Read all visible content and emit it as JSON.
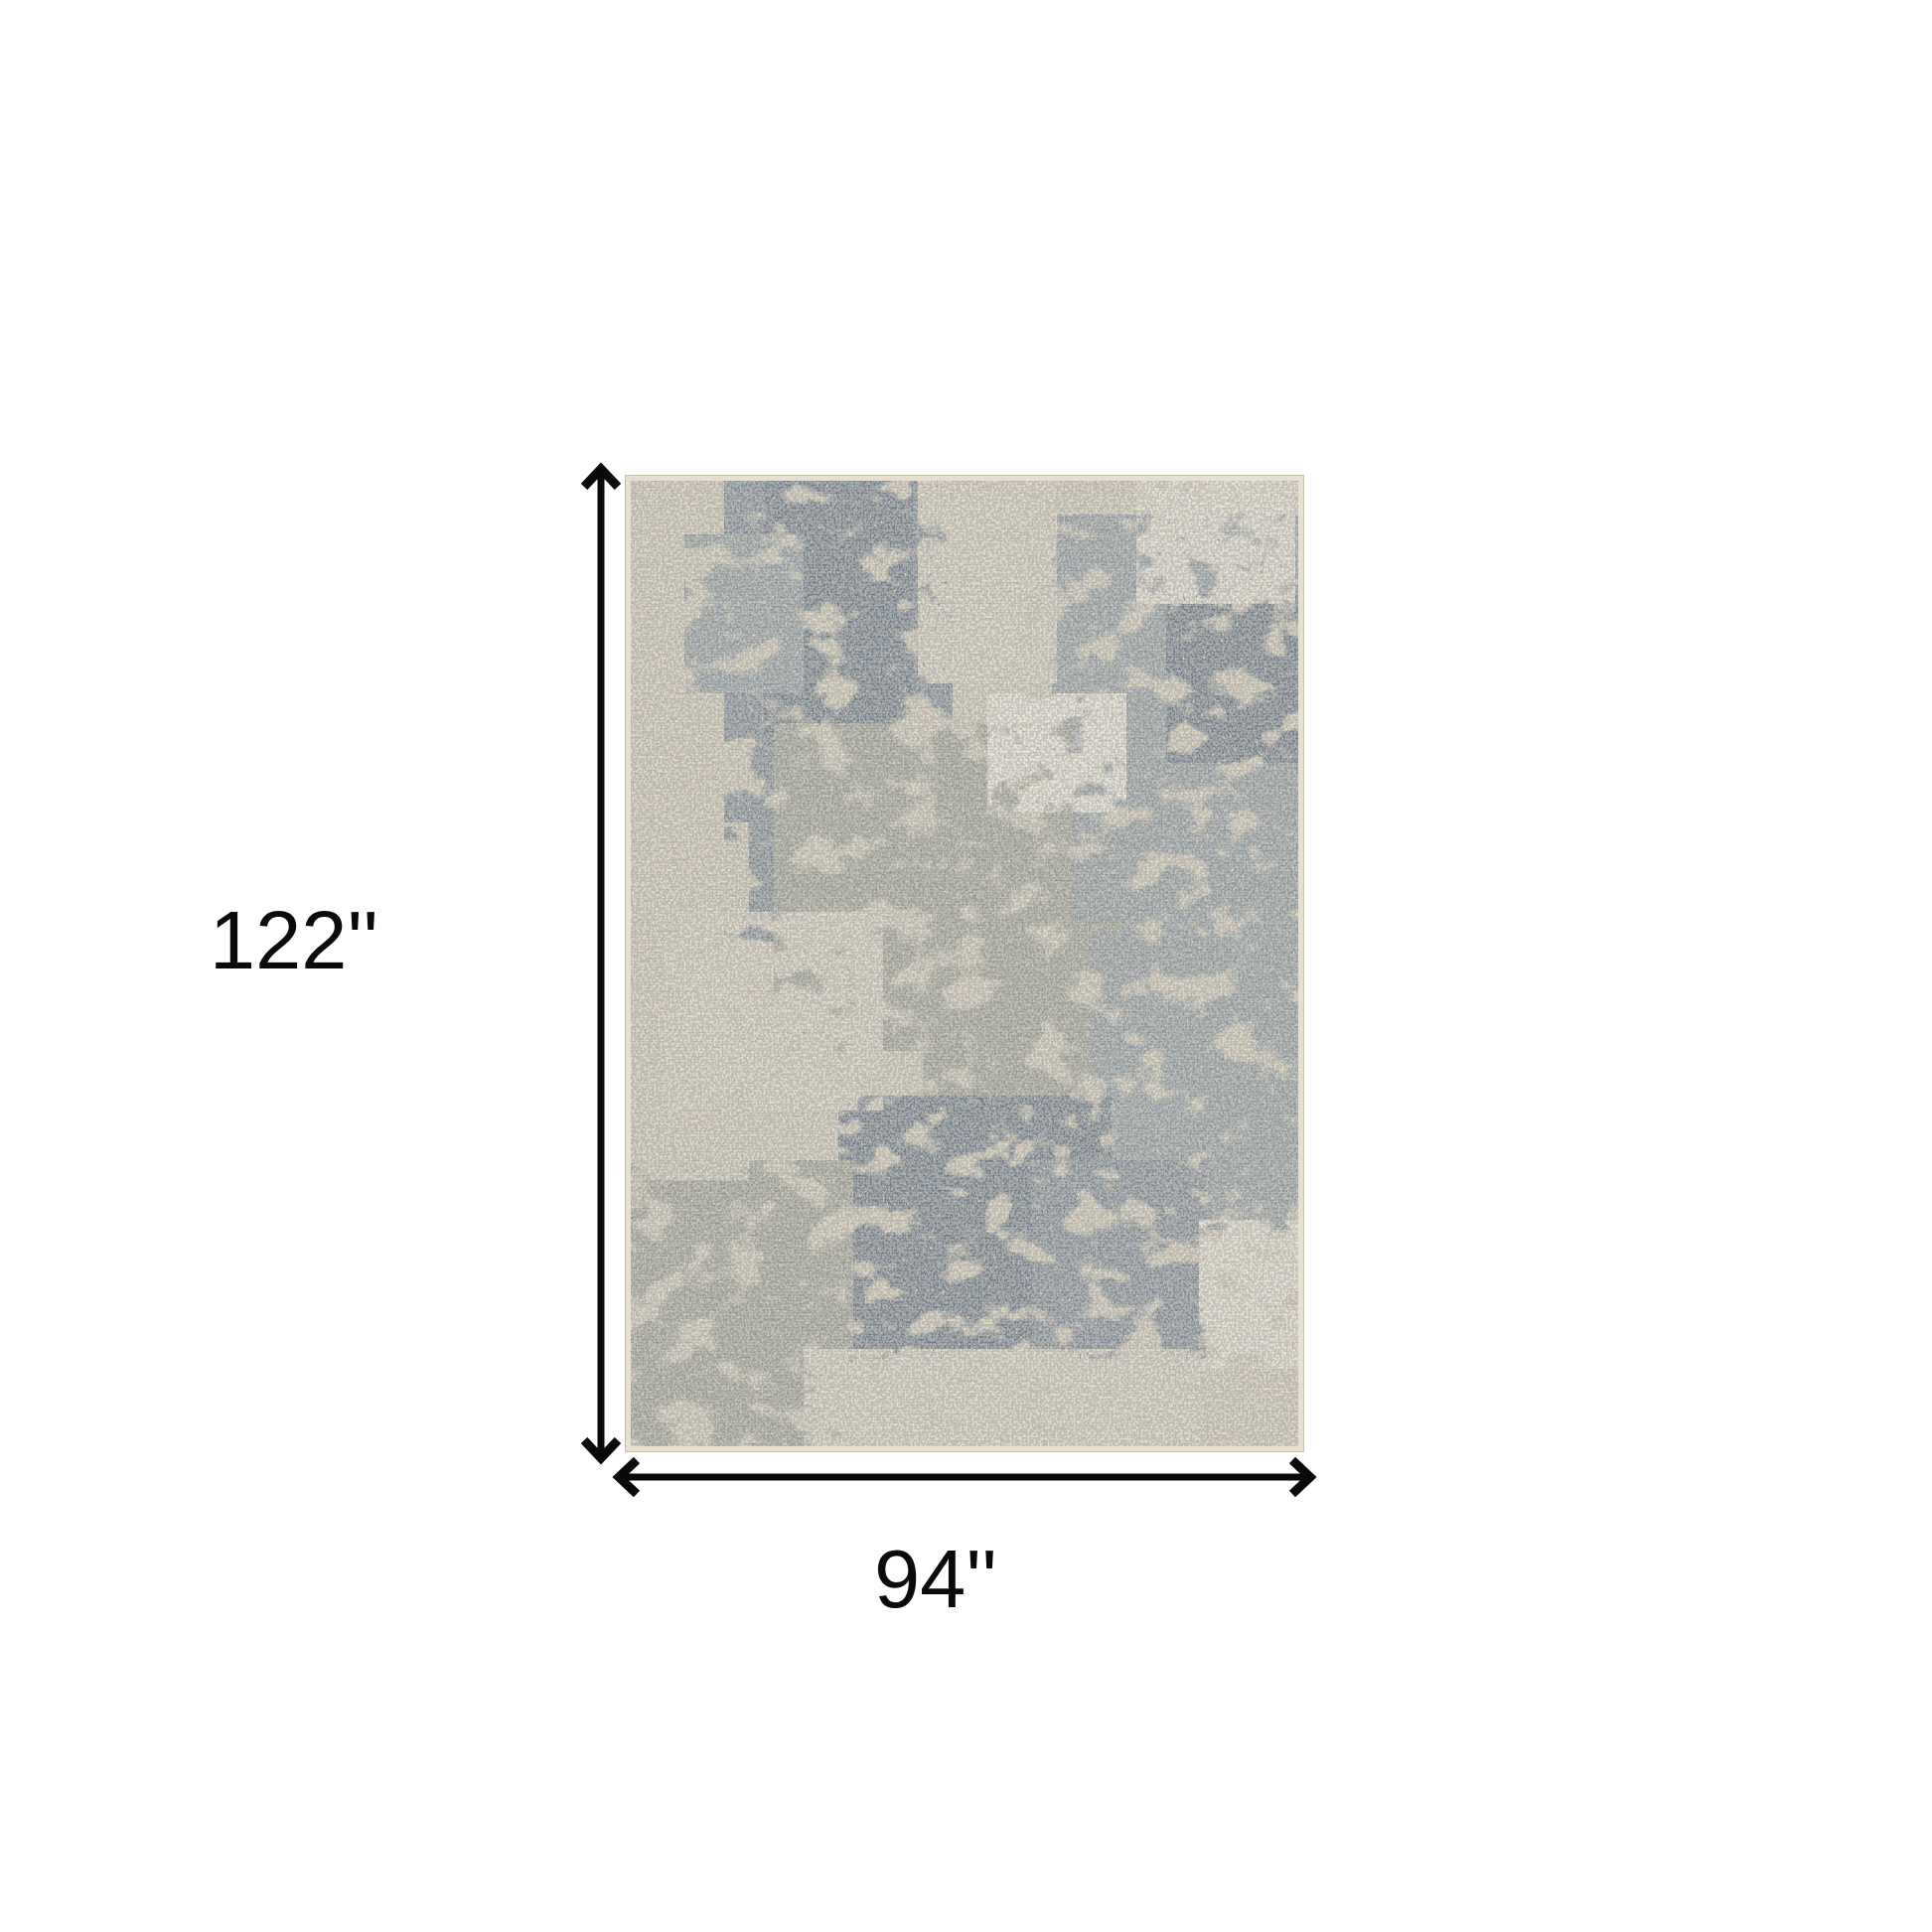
{
  "page": {
    "background_color": "#ffffff",
    "kind": "product dimension diagram"
  },
  "labels": {
    "height": "122''",
    "width": "94''"
  },
  "dimension_lines": {
    "color": "#0a0a0a"
  },
  "icons": {
    "height_arrow": "double-headed-vertical-arrow",
    "width_arrow": "double-headed-horizontal-arrow"
  },
  "rug": {
    "description": "beige and slate gray abstract distressed patchwork area rug",
    "palette": {
      "base_beige": "#d7cdb9",
      "beige_light": "#ddd4c1",
      "cream": "#e9e1d1",
      "cream_bright": "#efe8d8",
      "slate_dark": "#6f7c88",
      "slate": "#828d96",
      "gray_mid": "#97a0a3",
      "sage": "#a5a698",
      "edge_binding": "#e7dfcf",
      "edge_line": "#c8bfab",
      "speckle_dark": "#79838d",
      "speckle_light": "#f0e9da"
    }
  }
}
